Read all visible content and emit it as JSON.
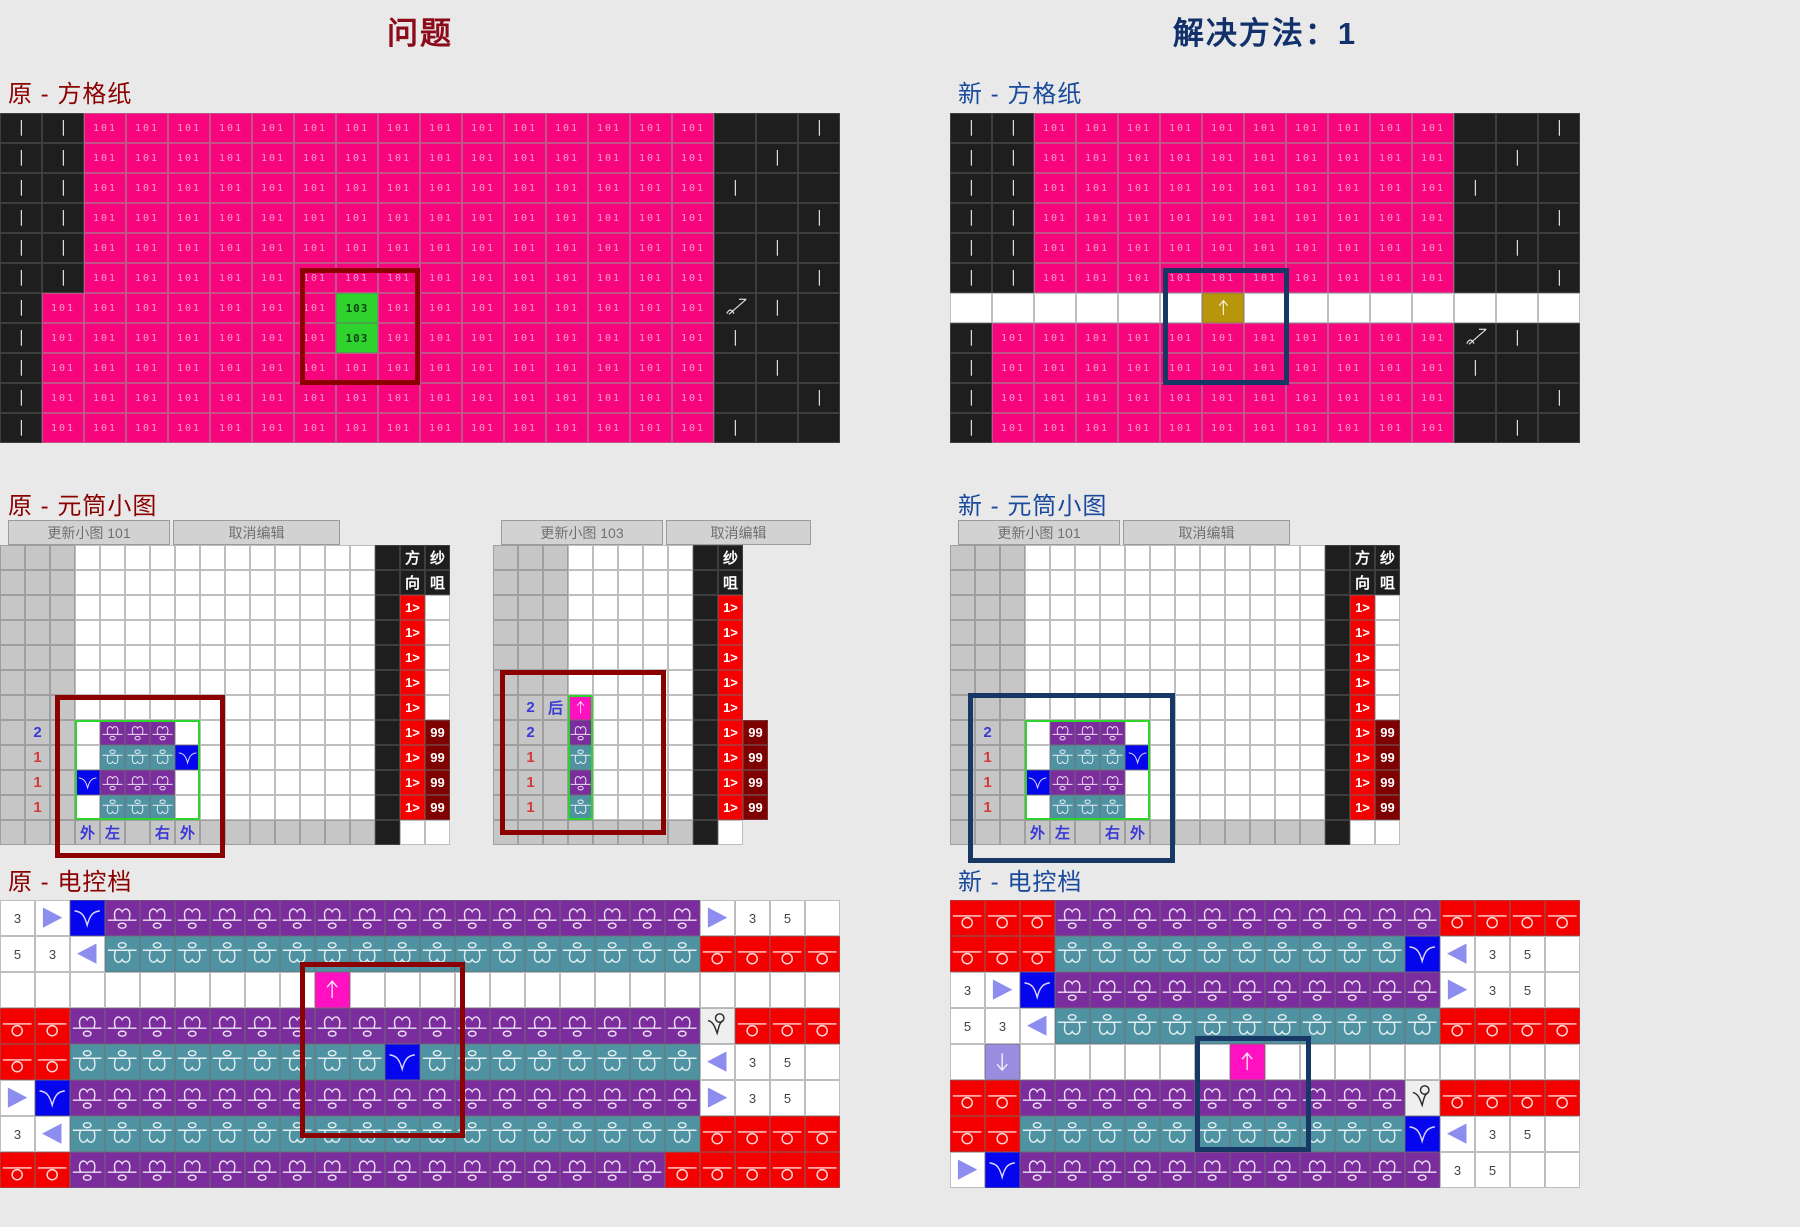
{
  "titles": {
    "left": "问题",
    "right": "解决方法：1"
  },
  "section_labels": {
    "paper_old": "原 - 方格纸",
    "paper_new": "新 - 方格纸",
    "small_old": "原 - 元筒小图",
    "small_new": "新 - 元筒小图",
    "ctl_old": "原 - 电控档",
    "ctl_new": "新 - 电控档"
  },
  "buttons": [
    {
      "label": "更新小图 101",
      "x": 8,
      "y": 520,
      "w": 162,
      "name": "update-small-chart-101-button"
    },
    {
      "label": "取消编辑",
      "x": 173,
      "y": 520,
      "w": 167,
      "name": "cancel-edit-button"
    },
    {
      "label": "更新小图 103",
      "x": 501,
      "y": 520,
      "w": 162,
      "name": "update-small-chart-103-button"
    },
    {
      "label": "取消编辑",
      "x": 666,
      "y": 520,
      "w": 145,
      "name": "cancel-edit-button"
    },
    {
      "label": "更新小图 101",
      "x": 958,
      "y": 520,
      "w": 162,
      "name": "update-small-chart-101-button"
    },
    {
      "label": "取消编辑",
      "x": 1123,
      "y": 520,
      "w": 167,
      "name": "cancel-edit-button"
    }
  ],
  "colors": {
    "background": "#e9e9e9",
    "stitch_pink": "#f7057d",
    "front_knit_purple": "#7b2d9e",
    "back_knit_teal": "#4f93a3",
    "yarn_red": "#f50000",
    "tuck_blue": "#0505ee",
    "insert_olive": "#b8960b",
    "arrow_magenta": "#ff10c0",
    "arrow_lavender": "#9a8de0",
    "selected_green": "#2ed32e",
    "count_maroon": "#7e0000",
    "problem_highlight": "#8b0000",
    "solution_highlight": "#173764"
  },
  "stitch_codes": {
    "normal": "101",
    "special": "103"
  },
  "yarn_feeder_count": "99",
  "direction_value": "1>",
  "grids": {
    "paperL": {
      "x": 0,
      "y": 113,
      "cw": 42,
      "ch": 30,
      "rows": [
        "I I 101*15 K K I",
        "I I 101*15 K I K",
        "I I 101*15 I K K",
        "I I 101*15 K K I",
        "I I 101*15 K I K",
        "I I 101*15 K K I",
        "I 101*7 103 101*8 X I K",
        "I 101*7 103 101*8 I K K",
        "I 101*16 K I K",
        "I 101*16 K K I",
        "I 101*16 I K K"
      ]
    },
    "paperR": {
      "x": 950,
      "y": 113,
      "cw": 42,
      "ch": 30,
      "rows": [
        "I I 101*10 K K I",
        "I I 101*10 K I K",
        "I I 101*10 I K K",
        "I I 101*10 K K I",
        "I I 101*10 K I K",
        "I I 101*10 K K I",
        "w*6 Y w*8",
        "I 101*11 X I K",
        "I 101*11 I K K",
        "I 101*11 K K I",
        "I 101*11 K I K"
      ]
    },
    "smallA": {
      "x": 0,
      "y": 545,
      "cw": 25,
      "ch": 25,
      "rows": [
        "g g g w*12 K 方 纱",
        "g g g w*12 K 向 咀",
        "g g g w*12 K 1> w",
        "g g g w*12 K 1> w",
        "g g g w*12 K 1> w",
        "g g g w*12 K 1> w",
        "g g g w*12 K 1> w",
        "g 2b g w P P P w w*7 K 1> 99",
        "g 1r g w T T T B w*7 K 1> 99",
        "g 1r g B P P P w w*7 K 1> 99",
        "g 1r g w T T T w w*7 K 1> 99",
        "g g g 外 左 g 右 外 g*7 K w w"
      ]
    },
    "smallA2": {
      "x": 493,
      "y": 545,
      "cw": 25,
      "ch": 25,
      "rows": [
        "g g g w*5 K 纱 x",
        "g g g w*5 K 咀 x",
        "g g g w*5 K 1> x",
        "g g g w*5 K 1> x",
        "g g g w*5 K 1> x",
        "g g g w*5 K 1> x",
        "g 2b 后 U w*4 K 1> x",
        "g 2b g P w*4 K 1> 99",
        "g 1r g T w*4 K 1> 99",
        "g 1r g P w*4 K 1> 99",
        "g 1r g T w*4 K 1> 99",
        "g g g g*5 K w x"
      ]
    },
    "smallB": {
      "x": 950,
      "y": 545,
      "cw": 25,
      "ch": 25,
      "rows": [
        "g g g w*12 K 方 纱",
        "g g g w*12 K 向 咀",
        "g g g w*12 K 1> w",
        "g g g w*12 K 1> w",
        "g g g w*12 K 1> w",
        "g g g w*12 K 1> w",
        "g g g w*12 K 1> w",
        "g 2b g w P P P w w*7 K 1> 99",
        "g 1r g w T T T B w*7 K 1> 99",
        "g 1r g B P P P w w*7 K 1> 99",
        "g 1r g w T T T w w*7 K 1> 99",
        "g g g 外 左 g 右 外 g*7 K w w"
      ]
    },
    "ctlL": {
      "x": 0,
      "y": 900,
      "cw": 35,
      "ch": 36,
      "rows": [
        "3w > B P*17 > 3w 5w w",
        "5w 3w < T*17 R R R R",
        "w*9 U w*14",
        "R R P*18 V R R R",
        "R R T*9 B T*8 < 3w 5w w",
        "> B P*18 > 3w 5w w",
        "3w < T*18 R R R R",
        "R R P*17 R*5"
      ]
    },
    "ctlR": {
      "x": 950,
      "y": 900,
      "cw": 35,
      "ch": 36,
      "rows": [
        "R R R P*11 R R R R",
        "R R R T*10 B < 3w 5w w",
        "3w > B P*11 > 3w 5w w",
        "5w 3w < T*11 R R R R",
        "w D w*6 U w*9",
        "R R P*11 V R R R R",
        "R R T*11 B < 3w 5w w",
        "> B P*12 3w 5w w w"
      ]
    }
  },
  "overlays": [
    {
      "x": 300,
      "y": 268,
      "w": 120,
      "h": 117,
      "color": "#8b0000",
      "t": 5,
      "name": "problem-highlight-paper"
    },
    {
      "x": 1163,
      "y": 268,
      "w": 126,
      "h": 117,
      "color": "#173764",
      "t": 5,
      "name": "solution-highlight-paper"
    },
    {
      "x": 75,
      "y": 720,
      "w": 125,
      "h": 100,
      "color": "#2ed32e",
      "t": 2,
      "name": "selection-box"
    },
    {
      "x": 55,
      "y": 695,
      "w": 170,
      "h": 163,
      "color": "#8b0000",
      "t": 5,
      "name": "problem-highlight-small-chart"
    },
    {
      "x": 568,
      "y": 695,
      "w": 25,
      "h": 125,
      "color": "#2ed32e",
      "t": 2,
      "name": "selection-box"
    },
    {
      "x": 500,
      "y": 670,
      "w": 166,
      "h": 165,
      "color": "#8b0000",
      "t": 5,
      "name": "problem-highlight-small-chart-103"
    },
    {
      "x": 1025,
      "y": 720,
      "w": 125,
      "h": 100,
      "color": "#2ed32e",
      "t": 2,
      "name": "selection-box"
    },
    {
      "x": 968,
      "y": 693,
      "w": 207,
      "h": 170,
      "color": "#173764",
      "t": 5,
      "name": "solution-highlight-small-chart"
    },
    {
      "x": 300,
      "y": 962,
      "w": 165,
      "h": 176,
      "color": "#8b0000",
      "t": 5,
      "name": "problem-highlight-control"
    },
    {
      "x": 1195,
      "y": 1036,
      "w": 116,
      "h": 116,
      "color": "#173764",
      "t": 5,
      "name": "solution-highlight-control"
    }
  ]
}
